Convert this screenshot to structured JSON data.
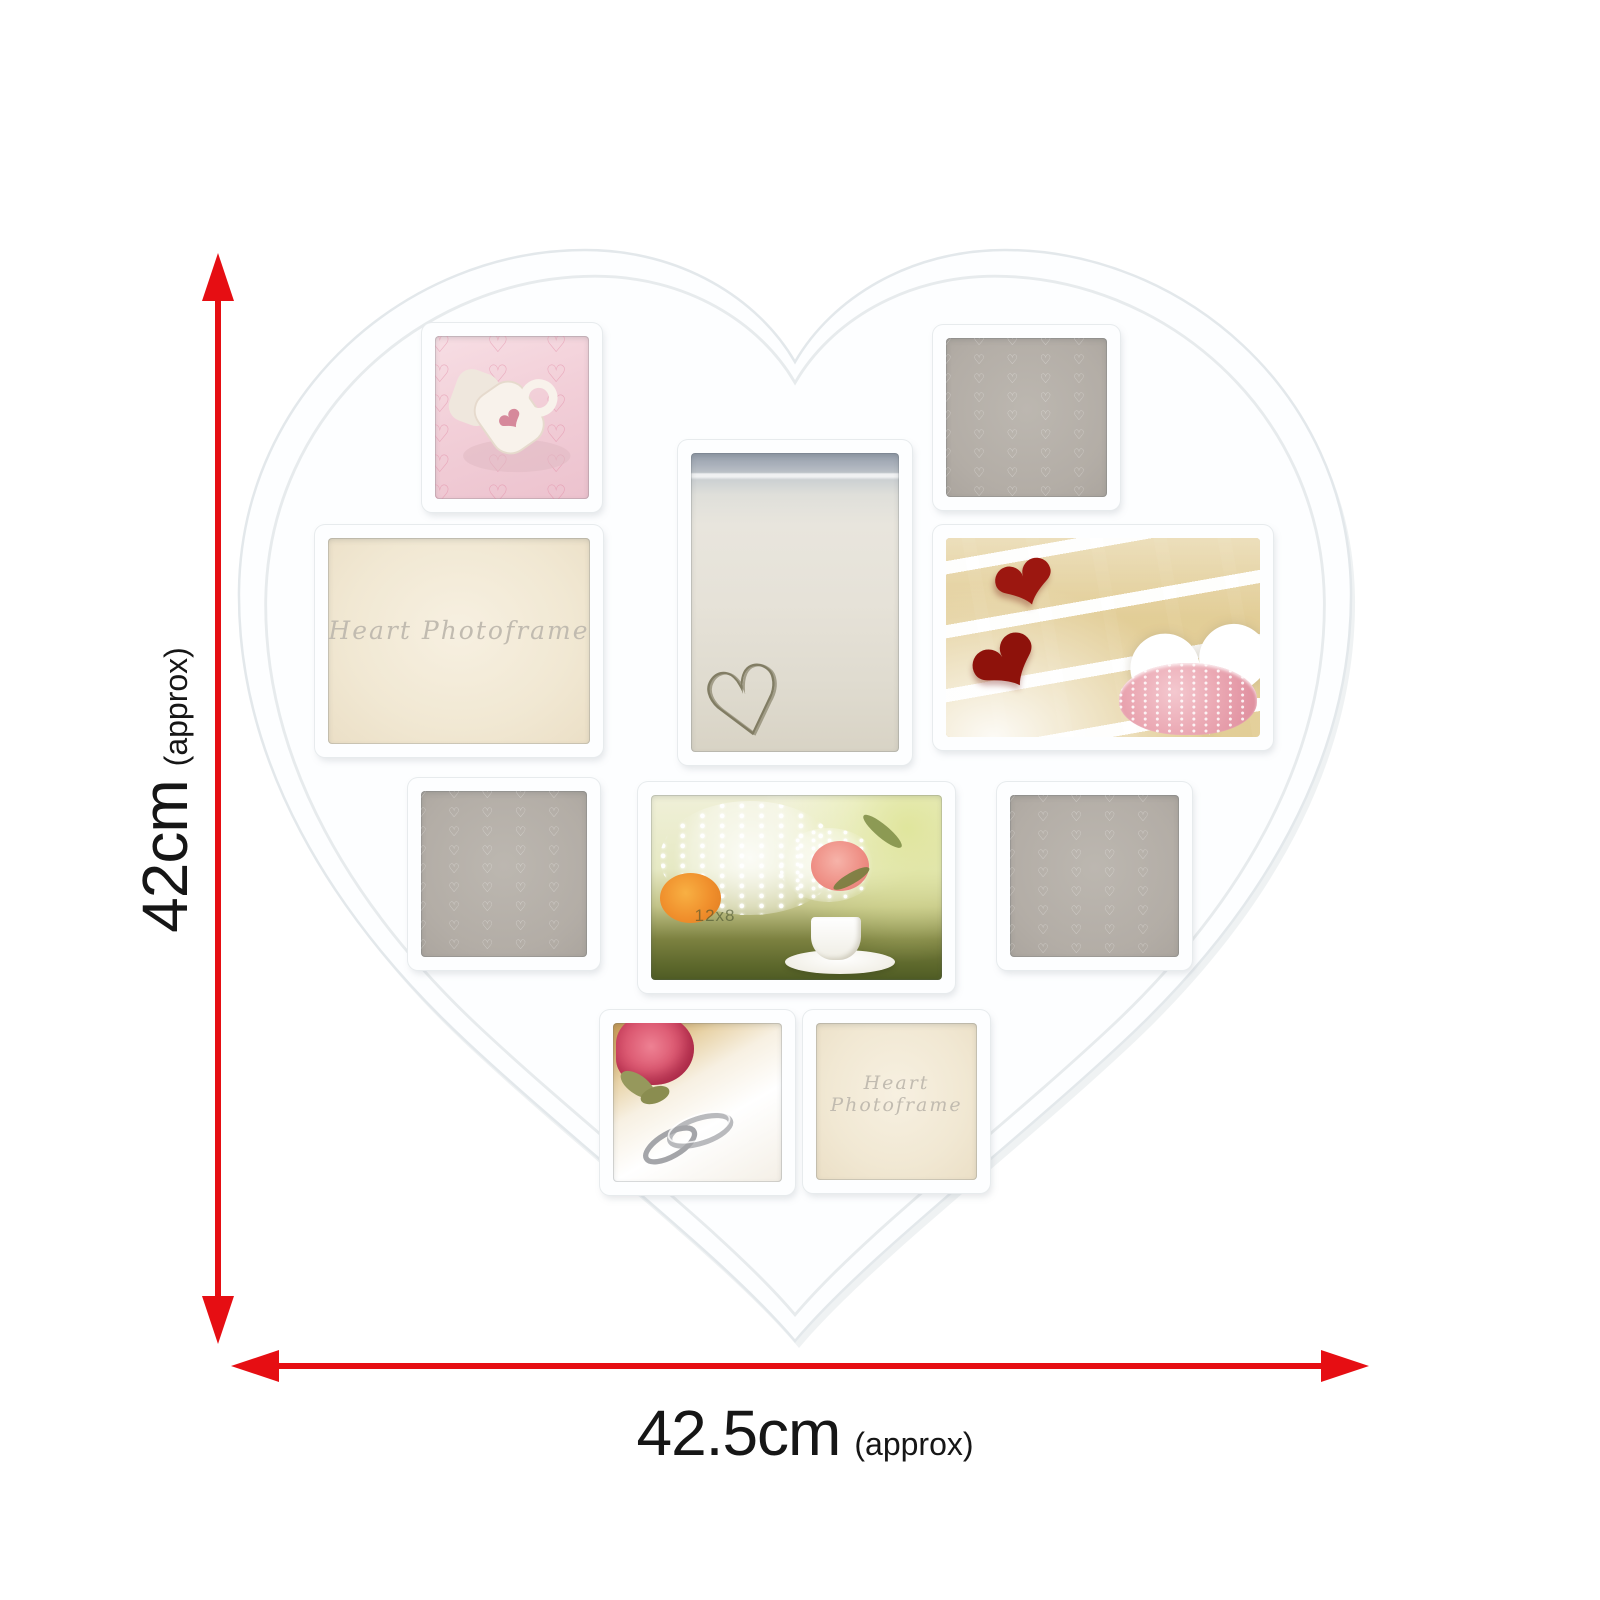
{
  "labels": {
    "height_value": "42cm",
    "height_qualifier": "(approx)",
    "width_value": "42.5cm",
    "width_qualifier": "(approx)"
  },
  "frame": {
    "placeholder_text": "Heart Photoframe",
    "watermark": "12x8",
    "pattern_glyph": "♡",
    "solid_heart_glyph": "❤"
  },
  "colors": {
    "arrow_red": "#e60e13",
    "heart_white": "#fdfeff",
    "edge_gray": "#e3e8eb",
    "placeholder_gray": "#b5afa8",
    "placeholder_cream": "#f2e9d6"
  },
  "slots": [
    {
      "id": "top-left-square",
      "content": "photo: white mug with pink hearts on heart-print fabric"
    },
    {
      "id": "top-right-square",
      "content": "empty gray insert with tiny heart pattern"
    },
    {
      "id": "center-portrait",
      "content": "photo: heart drawn in beach sand"
    },
    {
      "id": "middle-left-landscape",
      "content": "cream insert with Heart Photoframe script"
    },
    {
      "id": "middle-right-landscape",
      "content": "photo: red glass hearts on cream mosaic with pink salt dish"
    },
    {
      "id": "row3-left-square",
      "content": "empty gray insert with tiny heart pattern"
    },
    {
      "id": "row3-center-landscape",
      "content": "photo: wedding table flowers, baby's breath and teacup"
    },
    {
      "id": "row3-right-square",
      "content": "empty gray insert with tiny heart pattern"
    },
    {
      "id": "bottom-left-square",
      "content": "photo: wedding rings on white pillow with rose"
    },
    {
      "id": "bottom-right-square",
      "content": "cream insert with Heart Photoframe script"
    }
  ]
}
